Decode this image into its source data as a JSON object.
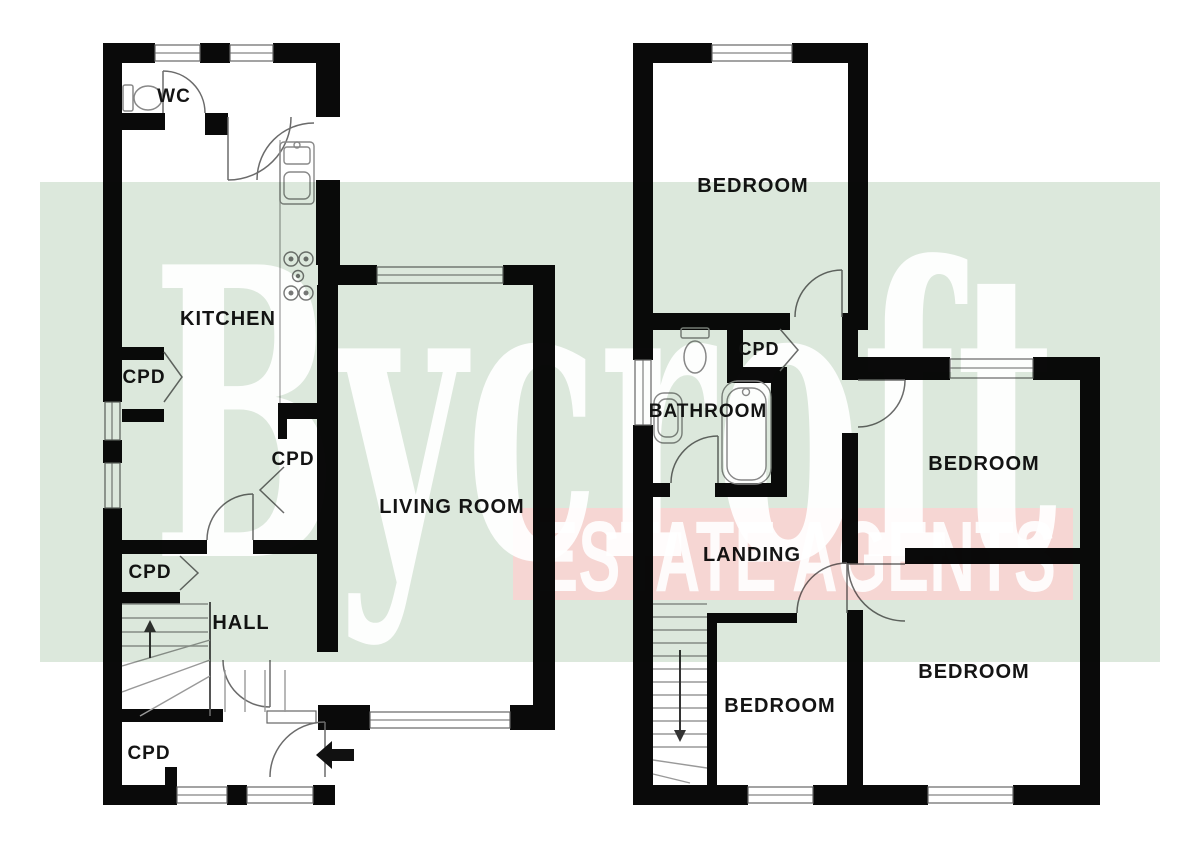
{
  "watermark": {
    "brand": "Bycroft",
    "tagline": "ESTATE AGENTS",
    "brand_band_color": "#dce8dc",
    "tagline_band_color": "#f6d6d3"
  },
  "ground_floor": {
    "wc": "WC",
    "kitchen": "KITCHEN",
    "living_room": "LIVING ROOM",
    "hall": "HALL",
    "cupboards": [
      "CPD",
      "CPD",
      "CPD",
      "CPD"
    ]
  },
  "first_floor": {
    "bedrooms": [
      "BEDROOM",
      "BEDROOM",
      "BEDROOM",
      "BEDROOM"
    ],
    "bathroom": "BATHROOM",
    "landing": "LANDING",
    "cupboard": "CPD"
  },
  "icons": {
    "entrance_arrow": "left-arrow",
    "stairs_up": "up-arrow",
    "stairs_down": "down-arrow",
    "toilet": "toilet",
    "bathtub": "bathtub",
    "basin": "basin",
    "sink": "sink",
    "hob": "hob"
  }
}
